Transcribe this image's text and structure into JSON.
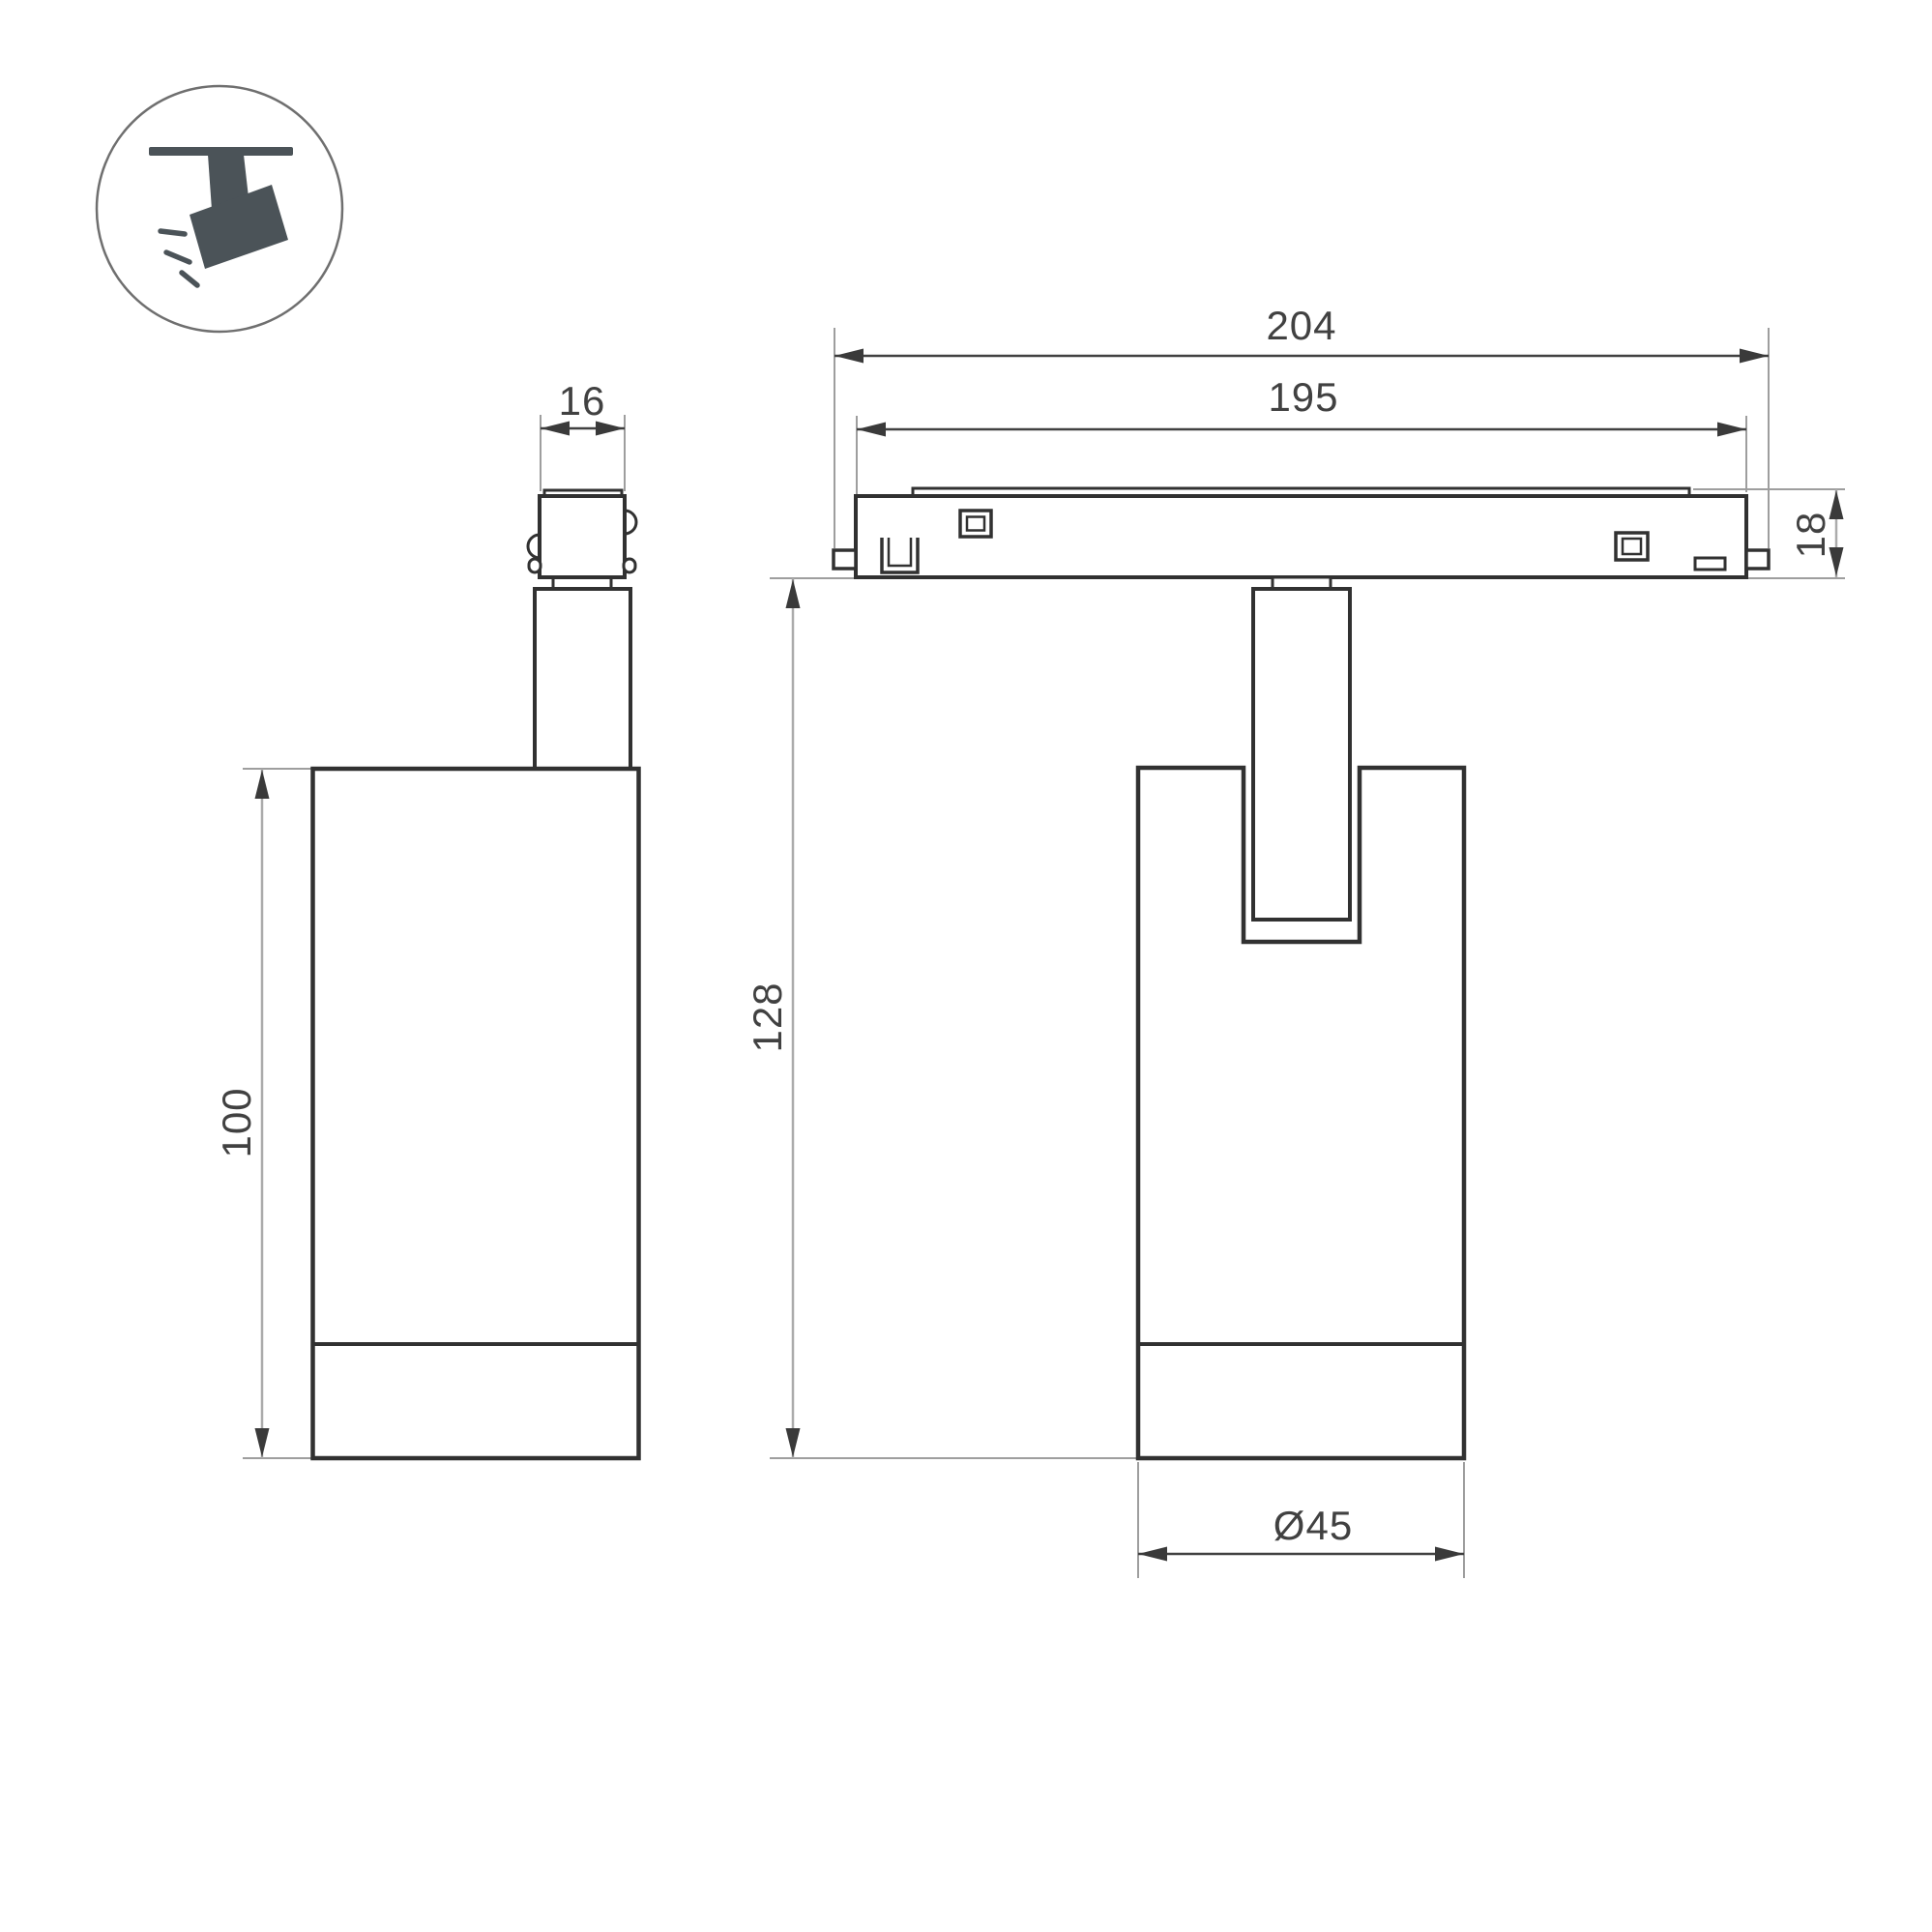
{
  "drawing": {
    "type": "technical-dimension-drawing",
    "subject": "magnetic-track-spotlight",
    "background": "#ffffff",
    "line_color": "#313131",
    "dim_text_color": "#414141",
    "ext_line_color": "#9e9e9e",
    "icon": {
      "name": "ceiling-track-spotlight-pictogram",
      "color": "#4b5358"
    },
    "side_view": {
      "adapter_width": "16",
      "body_height": "100"
    },
    "front_view": {
      "track_length_outer": "204",
      "track_length_body": "195",
      "track_height": "18",
      "drop_below_track": "128",
      "body_diameter": "Ø45"
    }
  }
}
